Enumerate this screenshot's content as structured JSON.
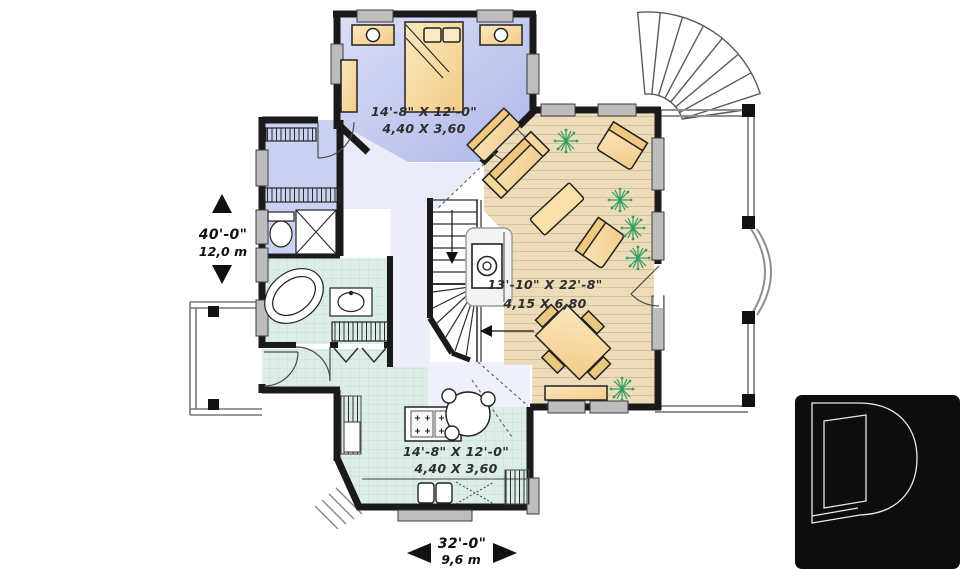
{
  "plan_title": "first-floor-plan",
  "rooms": [
    {
      "id": "bedroom",
      "imperial": "14'-8\" X 12'-0\"",
      "metric": "4,40 X 3,60"
    },
    {
      "id": "living-dining",
      "imperial": "13'-10\" X 22'-8\"",
      "metric": "4,15 X 6,80"
    },
    {
      "id": "kitchen",
      "imperial": "14'-8\" X 12'-0\"",
      "metric": "4,40 X 3,60"
    }
  ],
  "dimensions": {
    "vertical": {
      "imperial": "40'-0\"",
      "metric": "12,0 m"
    },
    "horizontal": {
      "imperial": "32'-0\"",
      "metric": "9,6 m"
    }
  },
  "logo": {
    "icon": "drummond-d-logo"
  },
  "colors": {
    "wall": "#1a1a1a",
    "window": "#bdbdbd",
    "bedroom_floor": "#c9cfee",
    "living_floor": "#eddcba",
    "kitchen_floor": "#ddeee8",
    "furniture": "#f5d28e",
    "plant": "#2f9e63",
    "railing": "#8f8f8f",
    "logo_background": "#0d0d0d"
  }
}
